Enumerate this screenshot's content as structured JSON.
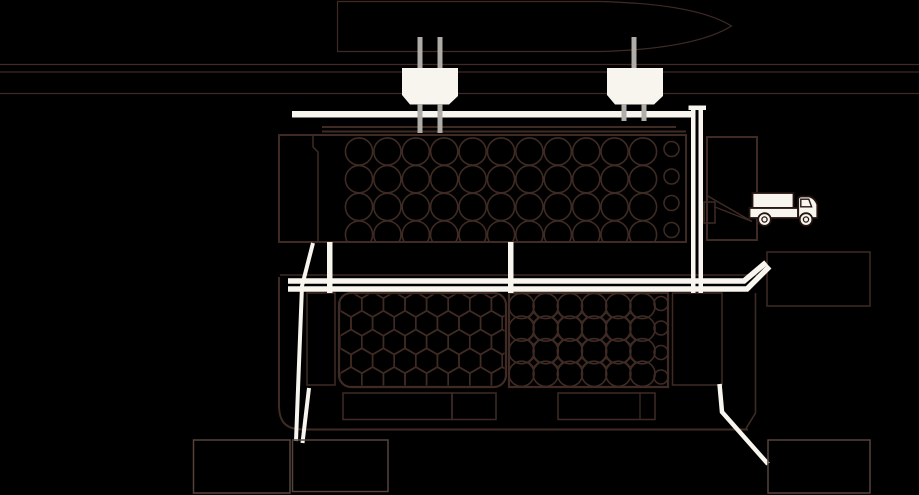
{
  "canvas": {
    "width": 919,
    "height": 495,
    "background": "#000000"
  },
  "palette": {
    "line": "#3f2b24",
    "line_soft": "#55433b",
    "white": "#f8f5ef",
    "gray": "#b0ada9",
    "truck_outline": "#241511",
    "black": "#000000"
  },
  "diagram": {
    "title": "port-facility-schematic",
    "icons": [
      "ship-bow-icon",
      "hopper-icon",
      "hopper-icon",
      "truck-icon",
      "log-stack-icon",
      "log-stack-icon",
      "log-stack-icon"
    ]
  },
  "clips": [
    {
      "id": "clip-top-bin",
      "x": 280,
      "y": 136,
      "w": 405,
      "h": 105,
      "rx": 0
    },
    {
      "id": "clip-left-bin",
      "x": 340.5,
      "y": 294.5,
      "w": 164,
      "h": 91,
      "rx": 11
    },
    {
      "id": "clip-right-bin",
      "x": 510,
      "y": 294,
      "w": 157,
      "h": 92,
      "rx": 0
    }
  ],
  "figures": [
    {
      "type": "line",
      "name": "waterline-1",
      "x1": 0,
      "y1": 64.5,
      "x2": 919,
      "y2": 64.5,
      "stroke": "line",
      "sw": 1.2
    },
    {
      "type": "line",
      "name": "waterline-2",
      "x1": 0,
      "y1": 72,
      "x2": 919,
      "y2": 72,
      "stroke": "line",
      "sw": 1.2
    },
    {
      "type": "line",
      "name": "waterline-3",
      "x1": 0,
      "y1": 93.5,
      "x2": 919,
      "y2": 93.5,
      "stroke": "line",
      "sw": 1.2
    },
    {
      "type": "path",
      "name": "ship-bow-icon",
      "d": "M337.5,1.5 L600,1.5 C655,3 704,9 731.5,26 C704,43 655,50 600,51.5 L337.5,51.5 Z",
      "stroke": "line",
      "sw": 1.2
    },
    {
      "type": "line",
      "name": "quay-edge-line-1",
      "x1": 322,
      "y1": 127,
      "x2": 676,
      "y2": 127,
      "stroke": "line",
      "sw": 2
    },
    {
      "type": "line",
      "name": "quay-edge-line-2",
      "x1": 322,
      "y1": 131.5,
      "x2": 686,
      "y2": 131.5,
      "stroke": "line",
      "sw": 2
    },
    {
      "type": "rect",
      "name": "top-container-outline",
      "x": 279,
      "y": 135,
      "w": 407,
      "h": 107,
      "stroke": "line",
      "sw": 2
    },
    {
      "type": "path",
      "name": "top-container-divider",
      "d": "M313,135 L313,147 L318,152 L318,242",
      "stroke": "line",
      "sw": 1.5
    },
    {
      "type": "circle-grid",
      "name": "log-stack-top",
      "item_name": "log-circle",
      "cols": 11,
      "rows": 4,
      "x0": 359,
      "y0": 151.5,
      "dx": 28.4,
      "dy": 27.7,
      "r": 13.6,
      "stroke": "line",
      "sw": 1.6,
      "clip": "clip-top-bin"
    },
    {
      "type": "circle-col",
      "name": "log-stack-top-small",
      "item_name": "log-circle-small",
      "cx": 671.5,
      "cys": [
        149,
        176.5,
        203,
        230
      ],
      "r": 7.5,
      "stroke": "line",
      "sw": 1.5,
      "clip": "clip-top-bin"
    },
    {
      "type": "rect",
      "name": "loading-bay-outline",
      "x": 707,
      "y": 137,
      "w": 50,
      "h": 103,
      "stroke": "line",
      "sw": 2
    },
    {
      "type": "rect",
      "name": "chute-box",
      "x": 704,
      "y": 202,
      "w": 11,
      "h": 21,
      "stroke": "line",
      "sw": 1.5
    },
    {
      "type": "line",
      "name": "chute-diagonal-1",
      "x1": 706,
      "y1": 195,
      "x2": 752,
      "y2": 221.5,
      "stroke": "line",
      "sw": 1.5
    },
    {
      "type": "line",
      "name": "chute-diagonal-2",
      "x1": 715,
      "y1": 207,
      "x2": 752,
      "y2": 221.5,
      "stroke": "line",
      "sw": 1.3
    },
    {
      "type": "line",
      "name": "lower-container-top-edge",
      "x1": 280,
      "y1": 275,
      "x2": 757,
      "y2": 275,
      "stroke": "line",
      "sw": 1.6
    },
    {
      "type": "path",
      "name": "lower-container-left-outline",
      "d": "M279,277 L279,405 C279,420 284,429 302,429.5 L748,429.5",
      "stroke": "line",
      "sw": 2
    },
    {
      "type": "path",
      "name": "lower-container-right-outline",
      "d": "M755.5,293 L755.5,413 L746,428.5",
      "stroke": "line",
      "sw": 1.6
    },
    {
      "type": "rect",
      "name": "lower-left-cell",
      "x": 307,
      "y": 293,
      "w": 28,
      "h": 92,
      "stroke": "line",
      "sw": 1.5
    },
    {
      "type": "rect",
      "name": "left-bin-outline",
      "x": 339,
      "y": 293,
      "w": 167,
      "h": 94,
      "rx": 12,
      "stroke": "line",
      "sw": 2.2
    },
    {
      "type": "hex-grid",
      "name": "hex-log-stack",
      "item_name": "hex-log-cell",
      "cols": 8,
      "rows": 5,
      "x0": 351,
      "y0": 304.5,
      "dx": 21.6,
      "dy": 18.75,
      "w": 21.6,
      "h": 25,
      "stroke": "line",
      "sw": 1.6,
      "clip": "clip-left-bin"
    },
    {
      "type": "rect",
      "name": "right-bin-outline",
      "x": 509,
      "y": 293,
      "w": 159,
      "h": 94,
      "stroke": "line",
      "sw": 2.2
    },
    {
      "type": "circle-grid",
      "name": "log-stack-lower",
      "item_name": "log-circle",
      "cols": 6,
      "rows": 4,
      "x0": 521.5,
      "y0": 306,
      "dx": 24.2,
      "dy": 22.6,
      "r": 12.6,
      "stroke": "line",
      "sw": 1.6,
      "clip": "clip-right-bin"
    },
    {
      "type": "diamond-grid",
      "name": "interstice-diamonds",
      "item_name": "diamond-gap",
      "cols": 5,
      "rows": 3,
      "x0": 533.6,
      "y0": 317.3,
      "dx": 24.2,
      "dy": 22.6,
      "s": 4.6,
      "stroke": "line",
      "sw": 1.3,
      "clip": "clip-right-bin"
    },
    {
      "type": "circle-col",
      "name": "log-stack-lower-small",
      "item_name": "log-circle-small",
      "cx": 661,
      "cys": [
        303.5,
        328,
        352.5,
        377
      ],
      "r": 7,
      "stroke": "line",
      "sw": 1.5,
      "clip": "clip-right-bin"
    },
    {
      "type": "rect",
      "name": "lower-right-cell",
      "x": 672.5,
      "y": 293,
      "w": 49.5,
      "h": 92,
      "stroke": "line",
      "sw": 1.5
    },
    {
      "type": "rect",
      "name": "machine-room-a",
      "x": 343,
      "y": 393,
      "w": 109,
      "h": 26.5,
      "stroke": "line",
      "sw": 1.5
    },
    {
      "type": "rect",
      "name": "machine-room-b",
      "x": 452,
      "y": 393,
      "w": 44,
      "h": 26.5,
      "stroke": "line",
      "sw": 1.5
    },
    {
      "type": "rect",
      "name": "machine-room-c",
      "x": 558,
      "y": 393,
      "w": 97,
      "h": 26.5,
      "stroke": "line",
      "sw": 1.5
    },
    {
      "type": "line",
      "name": "machine-room-c-divider",
      "x1": 640,
      "y1": 393,
      "x2": 640,
      "y2": 419.5,
      "stroke": "line",
      "sw": 1.3
    },
    {
      "type": "rect",
      "name": "side-building-right",
      "x": 767,
      "y": 252,
      "w": 103,
      "h": 54,
      "stroke": "line",
      "sw": 1.5
    },
    {
      "type": "polyline",
      "name": "service-pipe-left",
      "points": "313,243 302,286 296,441",
      "stroke": "white",
      "sw": 4
    },
    {
      "type": "line",
      "name": "service-pipe-left-2",
      "x1": 309,
      "y1": 388,
      "x2": 302.5,
      "y2": 443,
      "stroke": "white",
      "sw": 4
    },
    {
      "type": "polyline",
      "name": "service-pipe-right",
      "points": "719.5,384 722,412 768,464",
      "stroke": "white",
      "sw": 4.5
    },
    {
      "type": "rect",
      "name": "basement-room-left-1",
      "x": 193.5,
      "y": 440,
      "w": 96.5,
      "h": 53,
      "stroke": "line_soft",
      "sw": 1.5
    },
    {
      "type": "rect",
      "name": "basement-room-left-2",
      "x": 292.5,
      "y": 440,
      "w": 95.5,
      "h": 51.5,
      "stroke": "line_soft",
      "sw": 1.5
    },
    {
      "type": "rect",
      "name": "basement-room-right",
      "x": 768,
      "y": 440,
      "w": 102,
      "h": 53,
      "stroke": "line_soft",
      "sw": 1.5
    },
    {
      "type": "rect",
      "name": "upper-conveyor-pipe",
      "x": 292,
      "y": 111,
      "w": 402,
      "h": 6.5,
      "fill": "white"
    },
    {
      "type": "rect",
      "name": "mid-vertical-bar-1",
      "x": 327,
      "y": 242,
      "w": 5.5,
      "h": 51,
      "fill": "white"
    },
    {
      "type": "rect",
      "name": "mid-vertical-bar-2",
      "x": 508,
      "y": 242,
      "w": 5.5,
      "h": 51,
      "fill": "white"
    },
    {
      "type": "polyline",
      "name": "mid-conveyor-line-1",
      "points": "288,281 744,281 766,262.5",
      "stroke": "white",
      "sw": 5.5
    },
    {
      "type": "polyline",
      "name": "mid-conveyor-line-2",
      "points": "288,289 747,289 769.5,266.5",
      "stroke": "white",
      "sw": 5.5
    },
    {
      "type": "rect",
      "name": "right-pipe-cap",
      "x": 688.5,
      "y": 105.5,
      "w": 17.5,
      "h": 4.5,
      "fill": "white"
    },
    {
      "type": "rect",
      "name": "right-vertical-pipe-a",
      "x": 691,
      "y": 108,
      "w": 4.5,
      "h": 185,
      "fill": "white"
    },
    {
      "type": "rect",
      "name": "right-vertical-pipe-b",
      "x": 698.5,
      "y": 108,
      "w": 4.5,
      "h": 185,
      "fill": "white"
    },
    {
      "type": "rect",
      "name": "hopper1-pipe-top-left",
      "x": 417.5,
      "y": 37,
      "w": 5,
      "h": 32,
      "fill": "gray"
    },
    {
      "type": "rect",
      "name": "hopper1-pipe-top-right",
      "x": 437.5,
      "y": 37,
      "w": 5,
      "h": 32,
      "fill": "gray"
    },
    {
      "type": "rect",
      "name": "hopper2-pipe-top",
      "x": 631.5,
      "y": 37,
      "w": 5,
      "h": 32,
      "fill": "gray"
    },
    {
      "type": "polygon",
      "name": "hopper-icon-1",
      "points": "402,68 458,68 458,96 449,104.5 410,104.5 402,95",
      "fill": "white"
    },
    {
      "type": "polygon",
      "name": "hopper-icon-2",
      "points": "607,68 663,68 663,96 654,104.5 615,104.5 607,95",
      "fill": "white"
    },
    {
      "type": "rect",
      "name": "hopper1-leg-left",
      "x": 417.5,
      "y": 104,
      "w": 5,
      "h": 29,
      "fill": "gray"
    },
    {
      "type": "rect",
      "name": "hopper1-leg-right",
      "x": 437.5,
      "y": 104,
      "w": 5,
      "h": 29,
      "fill": "gray"
    },
    {
      "type": "rect",
      "name": "hopper2-leg-left",
      "x": 621.5,
      "y": 104,
      "w": 5,
      "h": 17,
      "fill": "gray"
    },
    {
      "type": "rect",
      "name": "hopper2-leg-right",
      "x": 641.5,
      "y": 104,
      "w": 5,
      "h": 17,
      "fill": "gray"
    },
    {
      "type": "rect",
      "name": "truck-cargo-box",
      "x": 752.5,
      "y": 193,
      "w": 41,
      "h": 15,
      "fill": "white",
      "stroke": "truck_outline",
      "sw": 1.8
    },
    {
      "type": "rect",
      "name": "truck-bed",
      "x": 749.5,
      "y": 208,
      "w": 48.5,
      "h": 10,
      "fill": "white",
      "stroke": "truck_outline",
      "sw": 1.8
    },
    {
      "type": "path",
      "name": "truck-cab",
      "d": "M798.2,218 L798.2,199.5 Q798.2,196.5 801.5,196.5 L809.5,196.5 Q815.5,198.5 817.3,204.5 L817.3,218 Z",
      "fill": "white",
      "stroke": "truck_outline",
      "sw": 1.8
    },
    {
      "type": "path",
      "name": "truck-cab-window",
      "d": "M800.8,199.2 L808.8,199.2 L811.6,206.8 L800.8,206.8 Z",
      "fill": "white",
      "stroke": "truck_outline",
      "sw": 1.4
    },
    {
      "type": "circle",
      "name": "truck-wheel-rear",
      "cx": 764.5,
      "cy": 219.5,
      "r": 6.3,
      "fill": "white",
      "stroke": "truck_outline",
      "sw": 1.8
    },
    {
      "type": "circle",
      "name": "truck-wheel-rear-hub",
      "cx": 764.5,
      "cy": 219.5,
      "r": 2.6,
      "stroke": "truck_outline",
      "sw": 1.3
    },
    {
      "type": "circle",
      "name": "truck-wheel-front",
      "cx": 806,
      "cy": 219.5,
      "r": 6.3,
      "fill": "white",
      "stroke": "truck_outline",
      "sw": 1.8
    },
    {
      "type": "circle",
      "name": "truck-wheel-front-hub",
      "cx": 806,
      "cy": 219.5,
      "r": 2.6,
      "stroke": "truck_outline",
      "sw": 1.3
    }
  ]
}
